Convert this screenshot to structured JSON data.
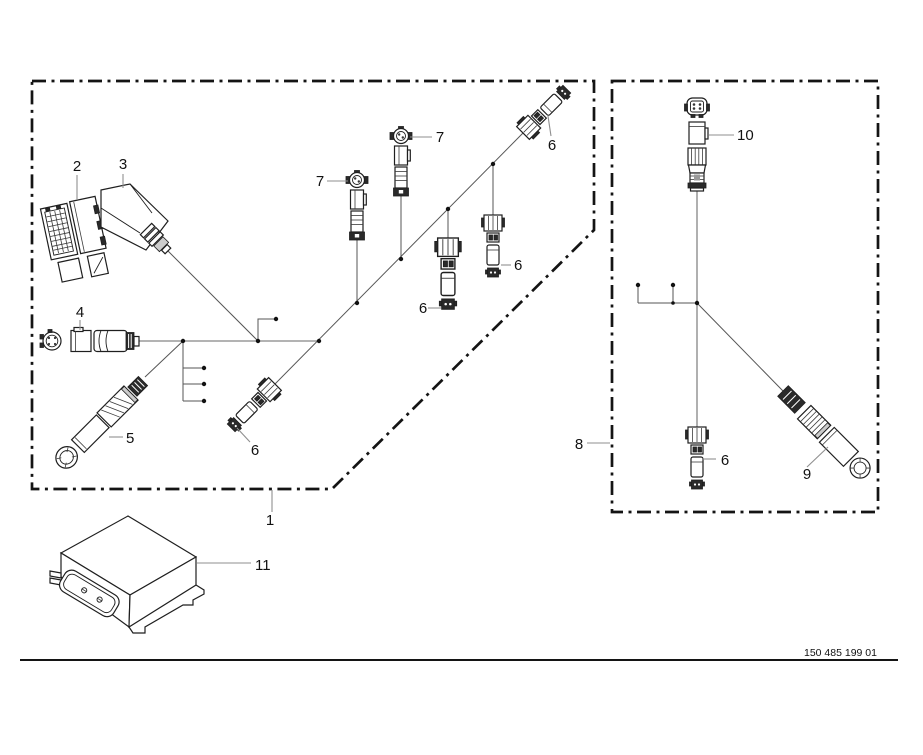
{
  "page": {
    "background": "#ffffff",
    "drawing_number": "150 485 199 01"
  },
  "colors": {
    "line_art": "#1f1f1f",
    "boundary": "#141414",
    "trunk_cable": "#a8a8a8",
    "branch_cable": "#555555",
    "leader_line": "#8f8f8f",
    "label_text": "#111111"
  },
  "callouts": {
    "harness_main": "1",
    "pin_housing": "2",
    "angled_boot": "3",
    "connector_4": "4",
    "connector_5": "5",
    "connector_6": "6",
    "connector_7": "7",
    "harness_secondary": "8",
    "connector_9": "9",
    "connector_10": "10",
    "control_unit": "11"
  }
}
